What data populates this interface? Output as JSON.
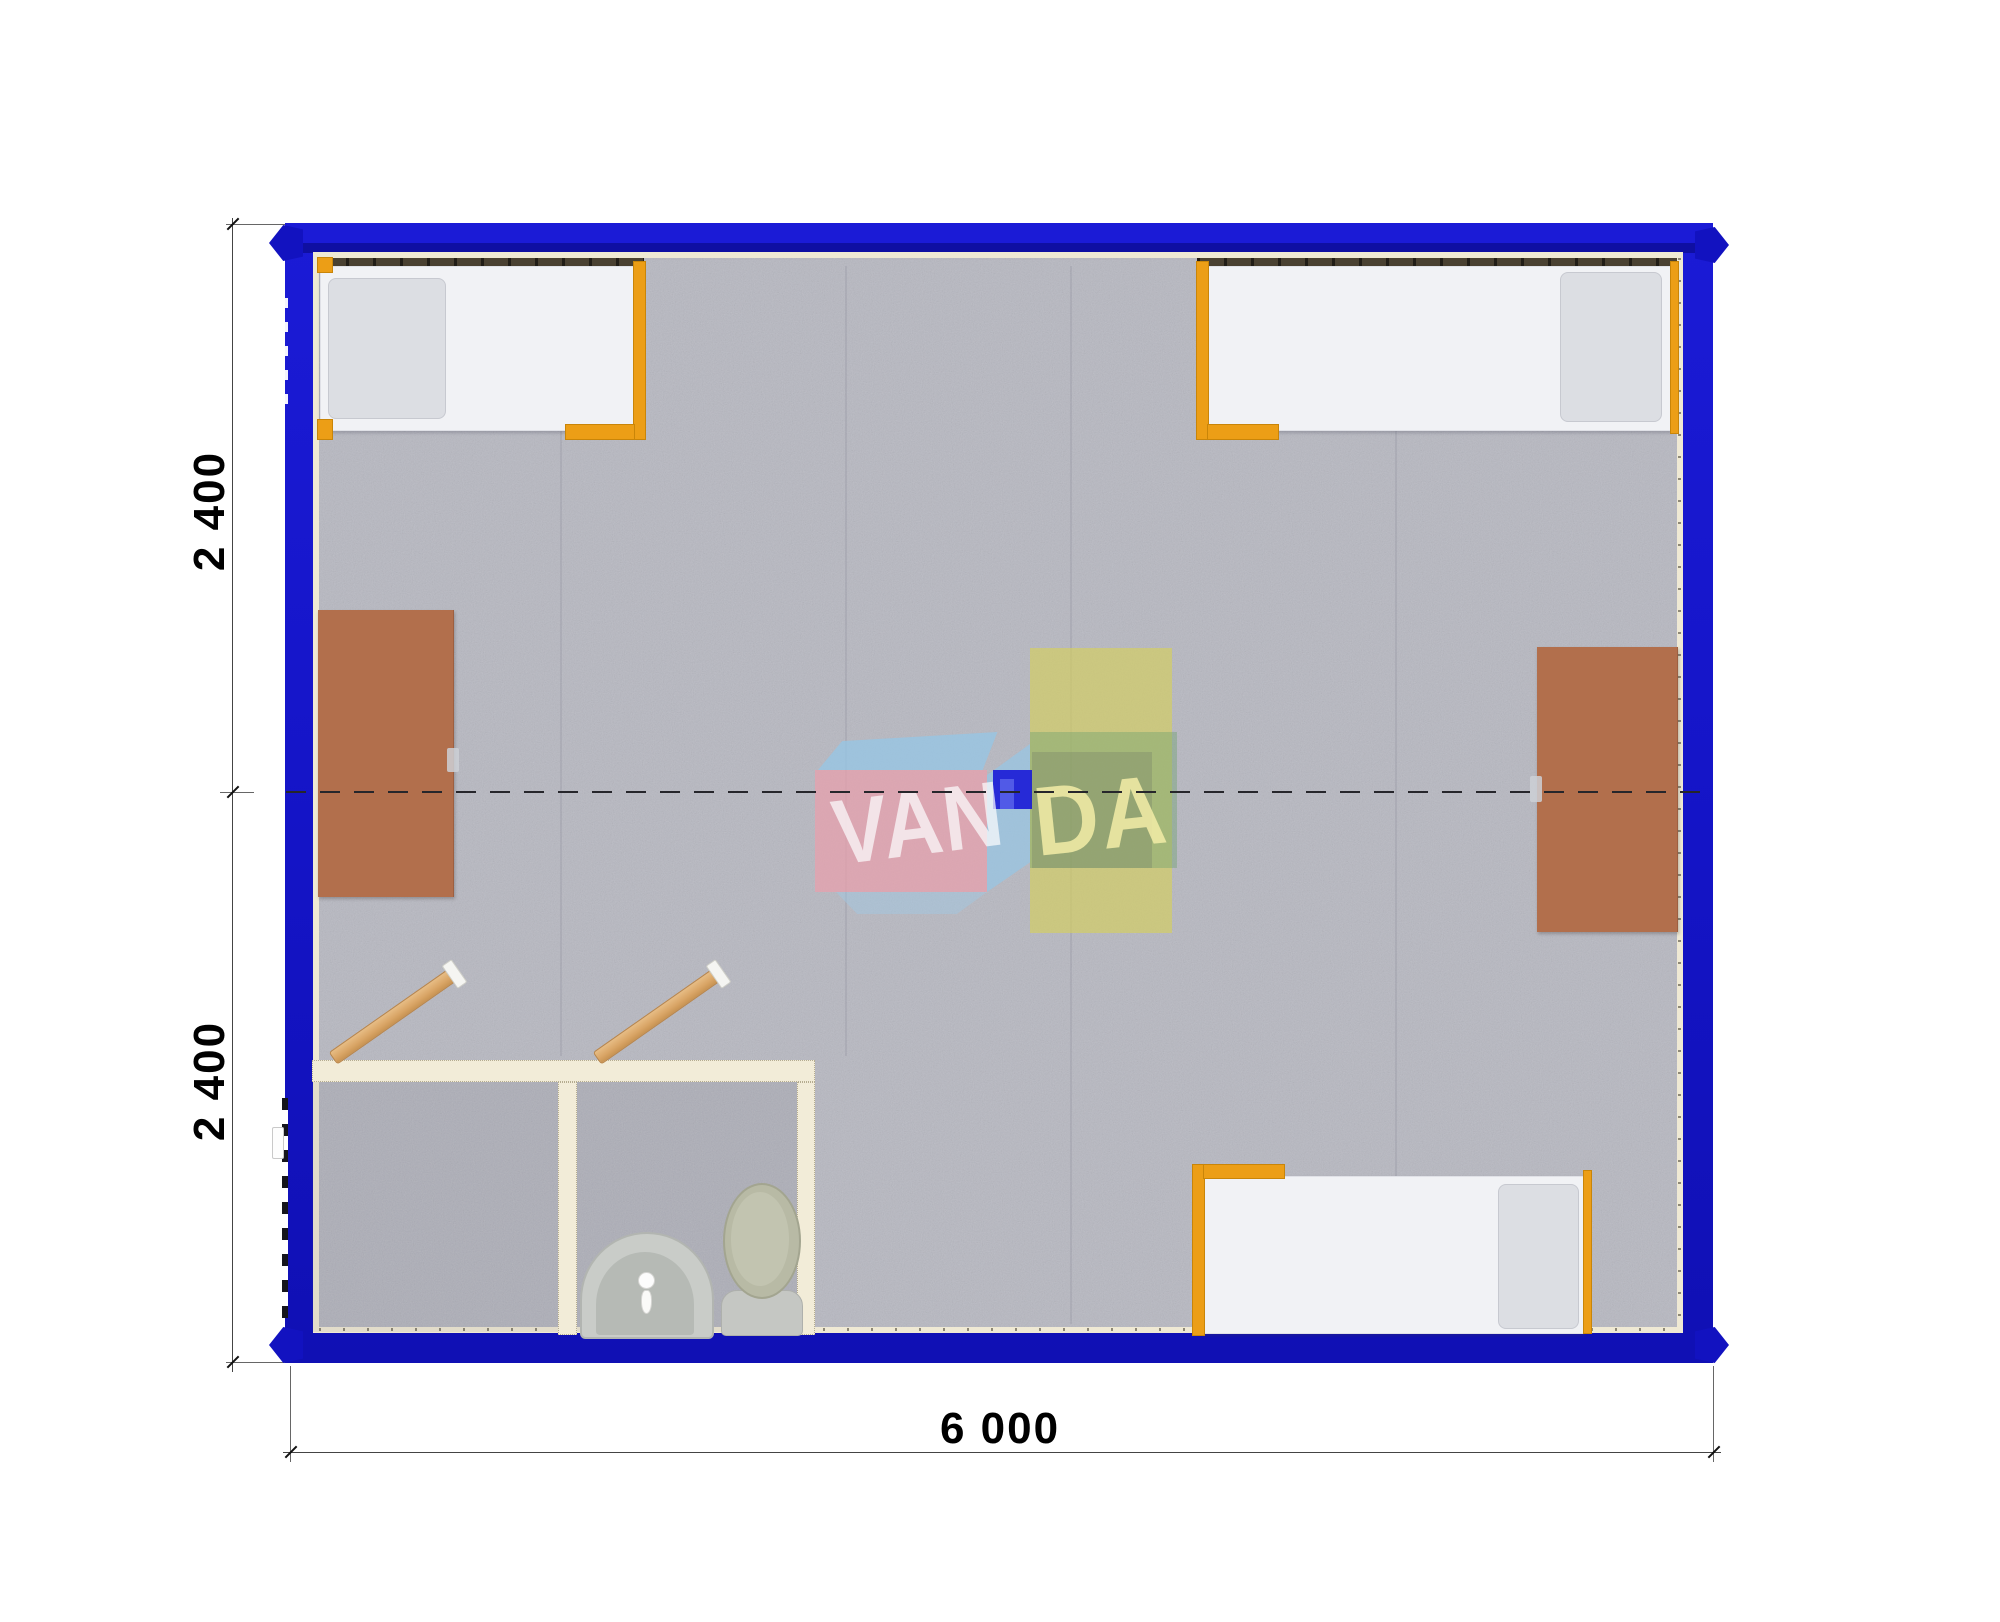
{
  "drawing": {
    "kind": "modular container cabin floor plan (top-down 3D render)",
    "dimensions": {
      "left_top_label": "2 400",
      "left_bottom_label": "2 400",
      "bottom_label": "6 000"
    },
    "watermark": {
      "front_text": "VAN",
      "side_text": "DA",
      "full_name": "VANDA"
    },
    "palette": {
      "frame_blue": "#1414C6",
      "frame_dark_blue": "#0F0FA2",
      "floor_gray": "#B7B8C1",
      "wall_cream": "#F2ECD8",
      "bed_white": "#F1F2F5",
      "bed_frame_orange": "#EC9E16",
      "table_brown": "#B26F4C",
      "door_tan": "#D9A566",
      "fixture_gray": "#C9CCC8",
      "toilet_lid_olive": "#B8BAA5",
      "watermark_pink": "#E8A0AC",
      "watermark_blue": "#96C6E4",
      "watermark_yellow": "#D4CE5F",
      "watermark_chip_blue": "#1516D6"
    },
    "contents": {
      "beds": 3,
      "folding_tables": 2,
      "bathroom_doors": 2,
      "sink": 1,
      "toilet": 1
    }
  }
}
